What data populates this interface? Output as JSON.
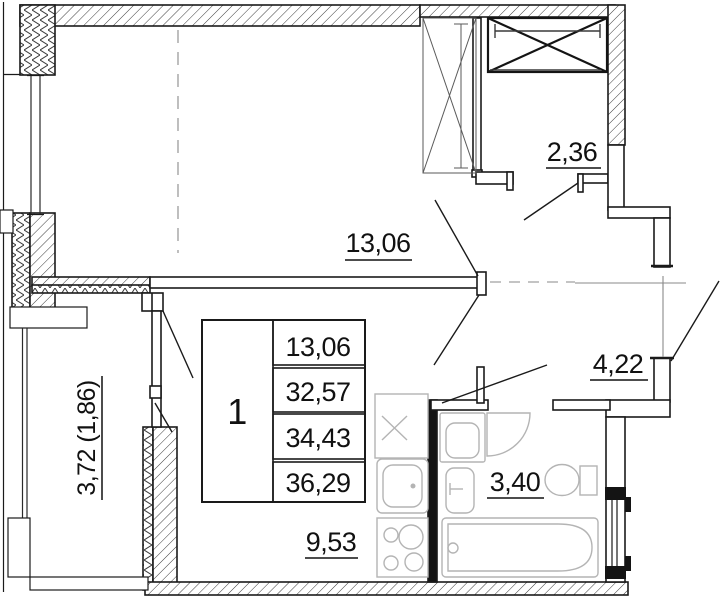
{
  "plan": {
    "type": "apartment floor plan",
    "colors": {
      "line": "#1a1a1a",
      "fixture": "#b4b4b4",
      "thin": "#8a8a8a",
      "bg": "#ffffff"
    },
    "rooms": {
      "living": {
        "area": "13,06"
      },
      "closet": {
        "area": "2,36"
      },
      "hall": {
        "area": "4,22"
      },
      "bath": {
        "area": "3,40"
      },
      "kitchen": {
        "area": "9,53"
      },
      "balcony": {
        "area": "3,72 (1,86)"
      }
    },
    "info_table": {
      "apartment_number": "1",
      "rows": [
        "13,06",
        "32,57",
        "34,43",
        "36,29"
      ]
    },
    "fixtures": [
      "wardrobe-cross-icon",
      "sliding-wardrobe-icon",
      "washing-machine-icon",
      "bathtub-icon",
      "toilet-icon",
      "washbasin-icon",
      "kitchen-sink-icon",
      "stove-icon"
    ]
  }
}
